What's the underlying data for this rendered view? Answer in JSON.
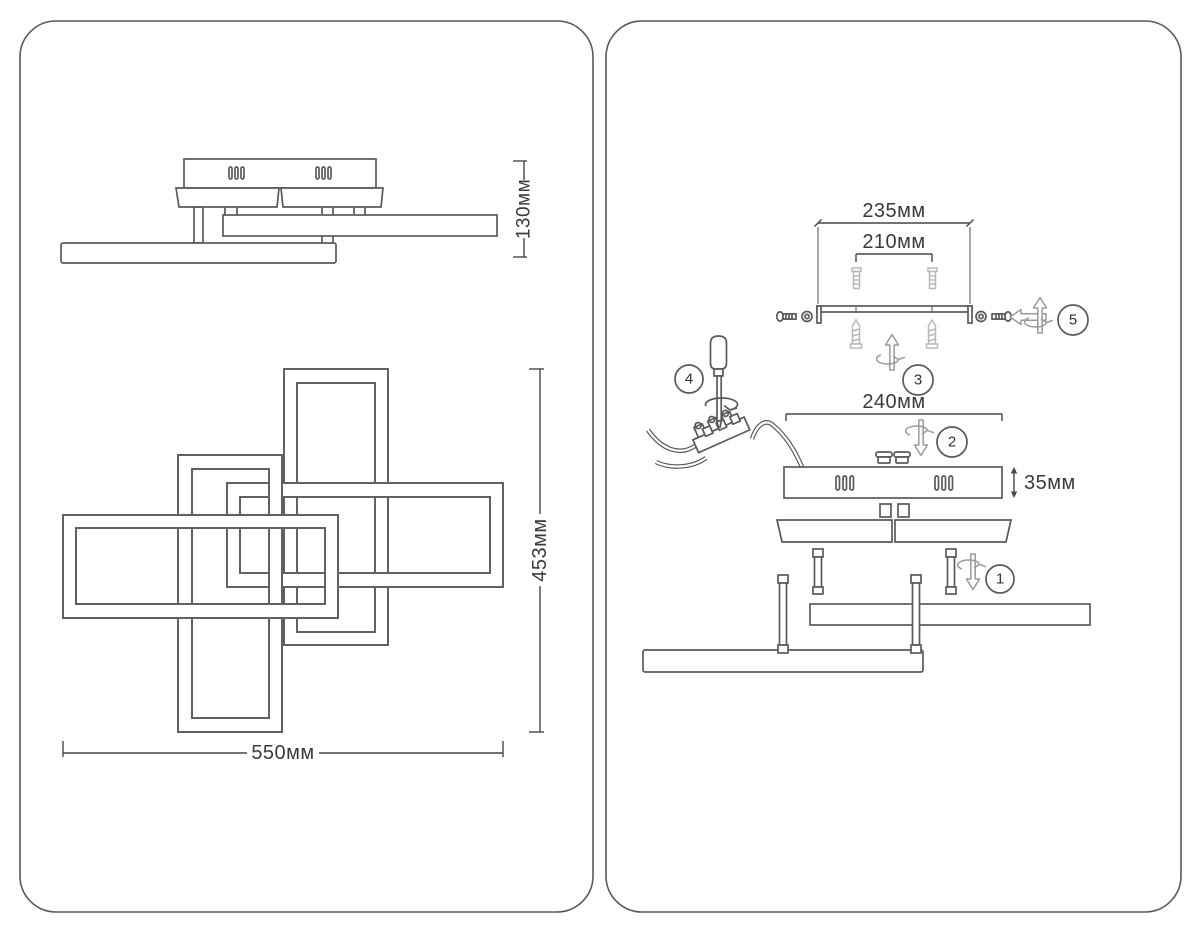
{
  "colors": {
    "line": "#5a5a5a",
    "light_line": "#b8b8b8",
    "dim_text": "#3a3a3a",
    "background": "#ffffff"
  },
  "left_panel": {
    "side_view": {
      "height_label": "130мм"
    },
    "top_view": {
      "width_label": "550мм",
      "height_label": "453мм"
    }
  },
  "right_panel": {
    "mounting_bracket": {
      "width_label": "235мм",
      "hole_spacing_label": "210мм"
    },
    "canopy": {
      "width_label": "240мм",
      "height_label": "35мм"
    },
    "steps": {
      "s1": "1",
      "s2": "2",
      "s3": "3",
      "s4": "4",
      "s5": "5"
    }
  }
}
